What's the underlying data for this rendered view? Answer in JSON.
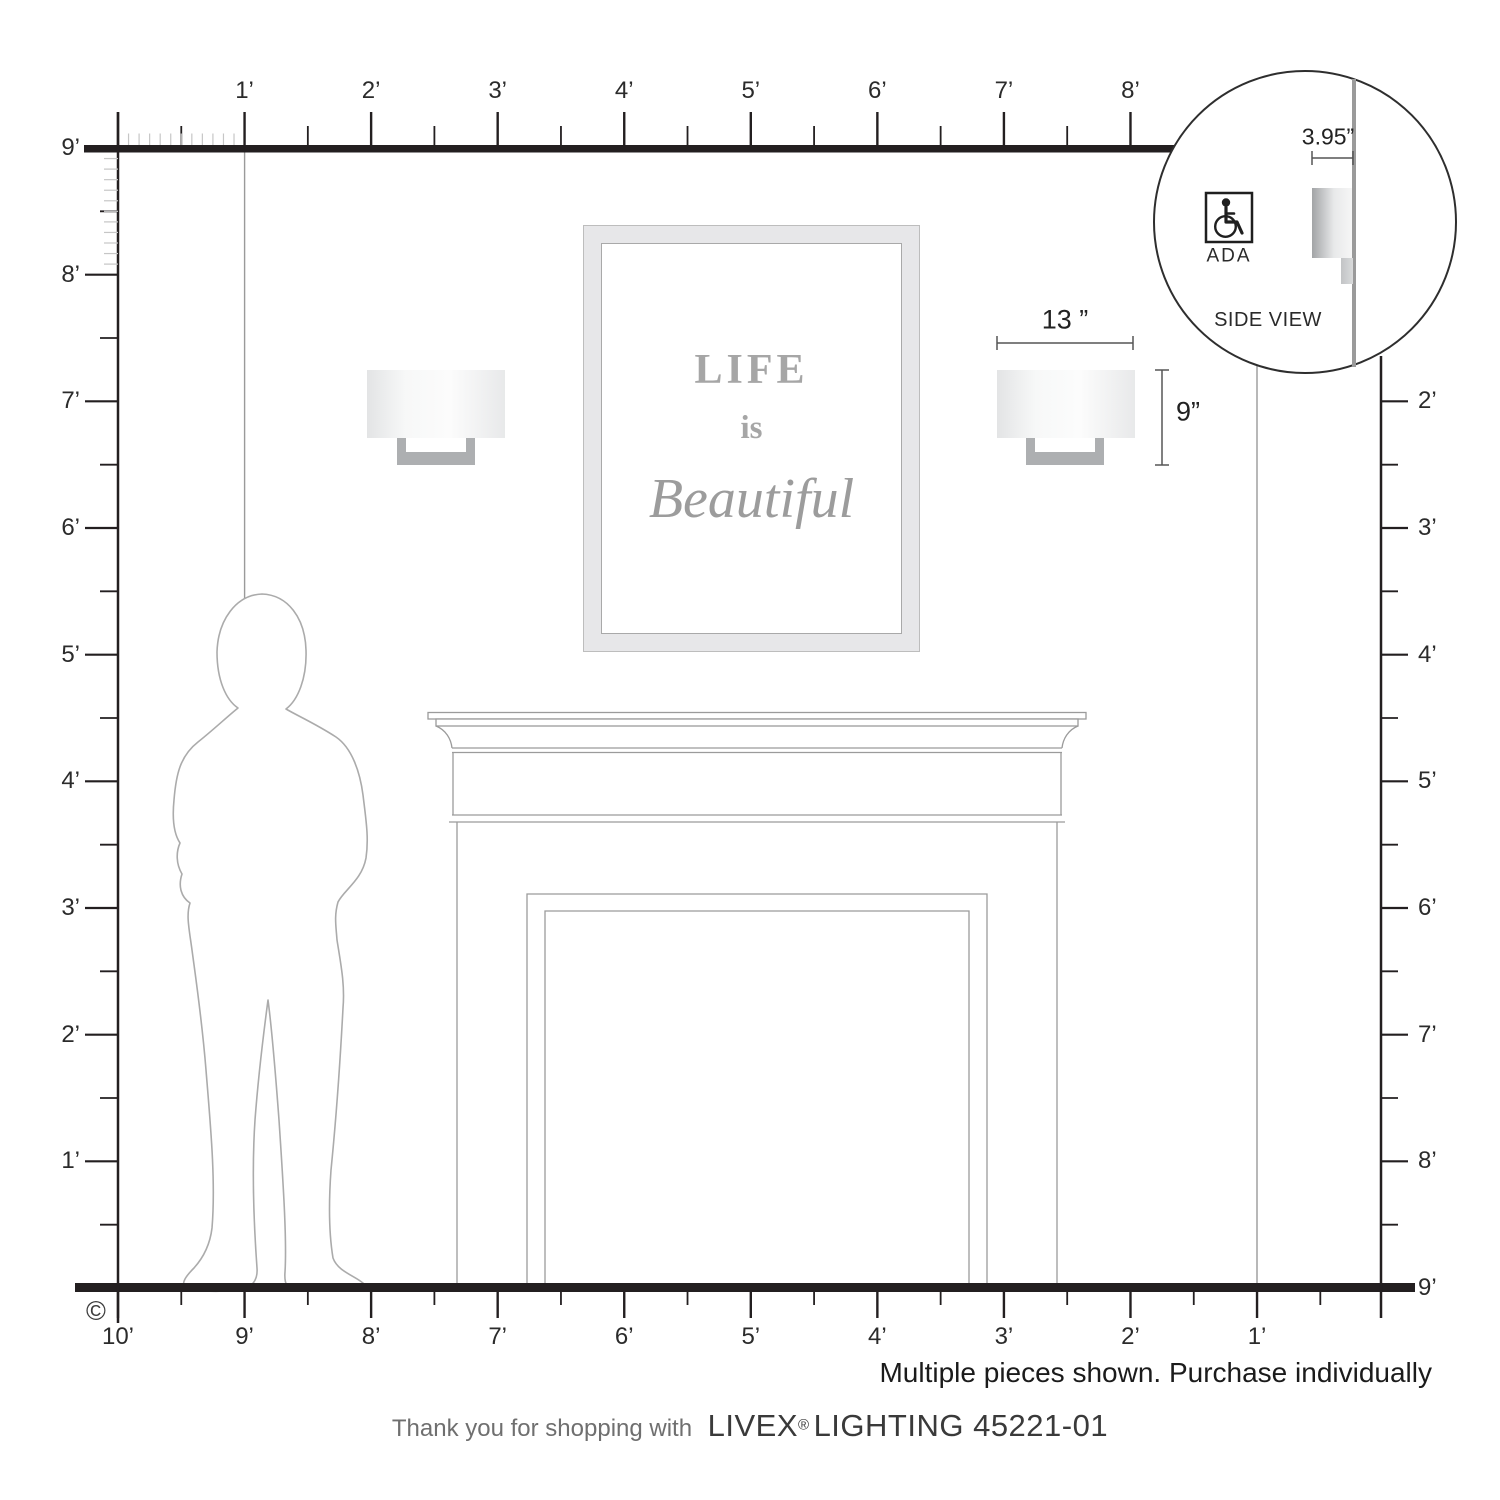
{
  "product": {
    "footer_prefix": "Thank you for shopping with",
    "brand": "LIVEX",
    "registered": "®",
    "brand_suffix": " LIGHTING 45221-01",
    "note": "Multiple pieces shown. Purchase individually",
    "copyright": "©"
  },
  "dimensions": {
    "width_label": "13 ”",
    "height_label": "9”",
    "depth_label": "3.95”"
  },
  "inset": {
    "title": "SIDE VIEW",
    "ada_label": "ADA",
    "ada_icon": "wheelchair-icon"
  },
  "artwork": {
    "line1": "LIFE",
    "line2": "is",
    "line3": "Beautiful"
  },
  "rulers": {
    "top_labels": [
      "1’",
      "2’",
      "3’",
      "4’",
      "5’",
      "6’",
      "7’",
      "8’"
    ],
    "left_labels": [
      "9’",
      "8’",
      "7’",
      "6’",
      "5’",
      "4’",
      "3’",
      "2’",
      "1’"
    ],
    "right_labels": [
      "2’",
      "3’",
      "4’",
      "5’",
      "6’",
      "7’",
      "8’",
      "9’"
    ],
    "bottom_labels": [
      "10’",
      "9’",
      "8’",
      "7’",
      "6’",
      "5’",
      "4’",
      "3’",
      "2’",
      "1’"
    ]
  },
  "colors": {
    "ruler_dark": "#231f20",
    "tick_light": "#c6c6c6",
    "wall_line": "#9a9a9a",
    "outline_gray": "#9b9b9b",
    "bracket_gray": "#adafb1",
    "frame_band": "#e7e7e9",
    "artwork_text": "#a6a6a6"
  }
}
